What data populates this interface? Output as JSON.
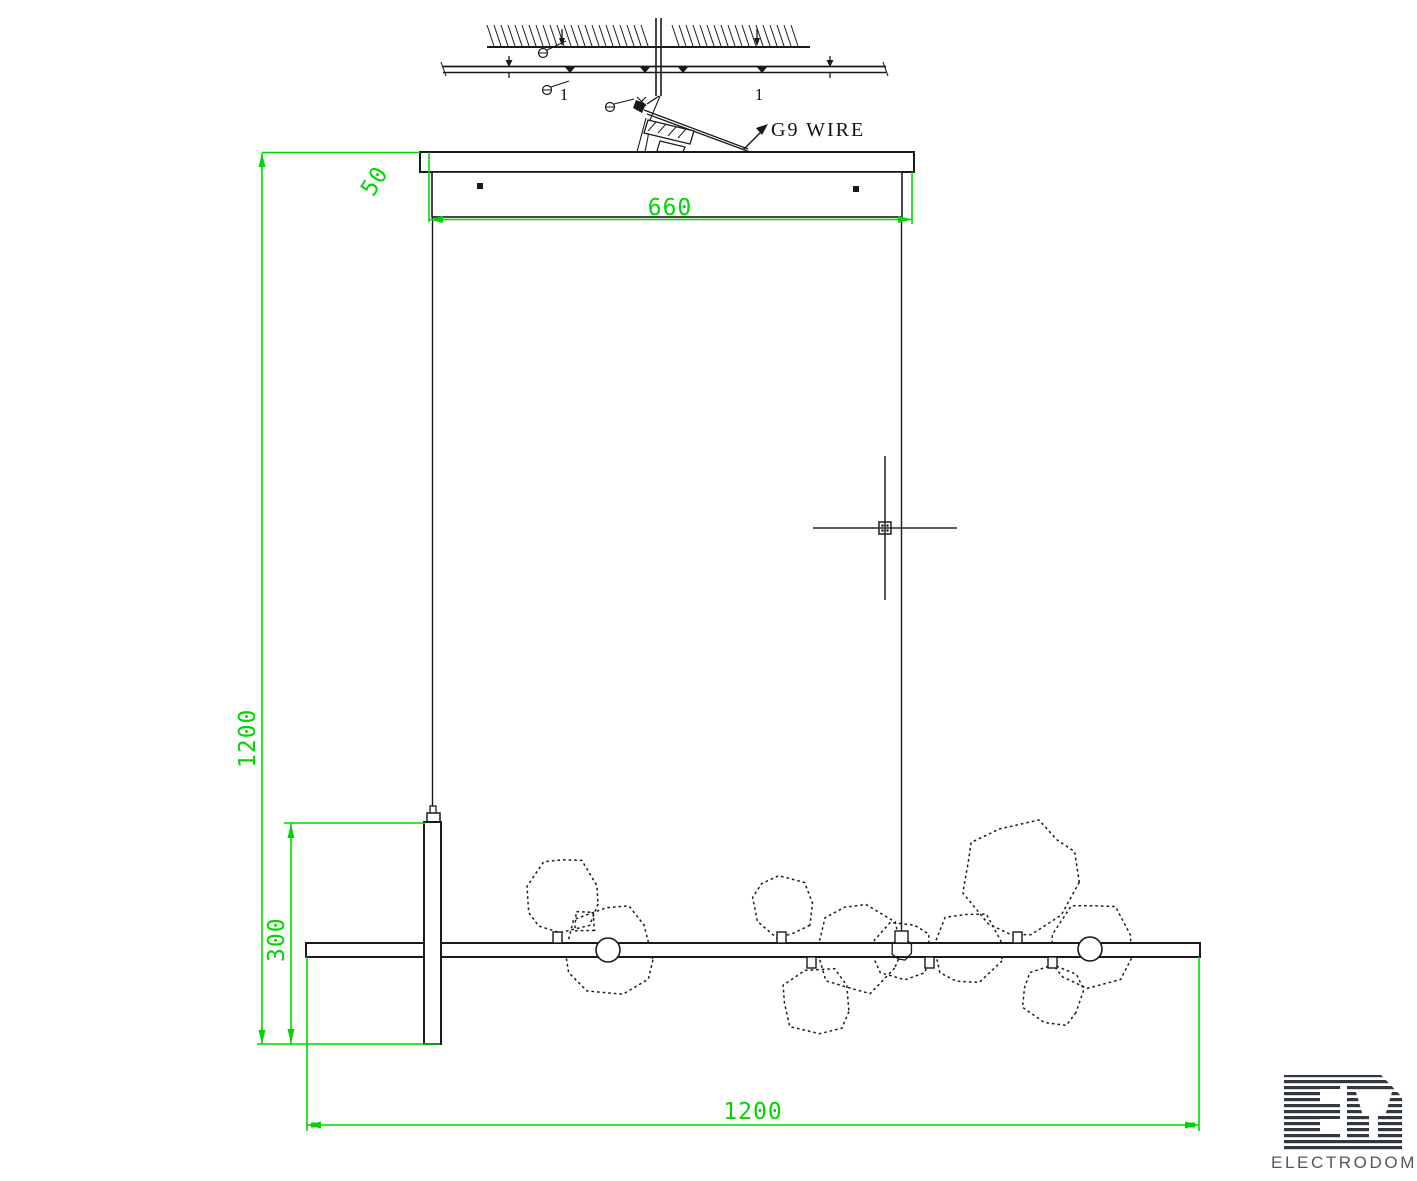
{
  "drawing": {
    "type": "pendant-light installation drawing",
    "background": "#ffffff"
  },
  "colors": {
    "dimension_green": "#00d500",
    "line_black": "#1a1a1a",
    "logo_dark": "#32383e",
    "logo_text_gray": "#55575a"
  },
  "labels": {
    "g9_wire": "G9 WIRE",
    "rail_mark_left": "1",
    "rail_mark_right": "1"
  },
  "dimensions": {
    "canopy_width": "660",
    "canopy_height": "50",
    "overall_drop": "1200",
    "tube_height": "300",
    "bar_length": "1200"
  },
  "logo": {
    "monogram": "ED",
    "name": "ELECTRODOM"
  }
}
